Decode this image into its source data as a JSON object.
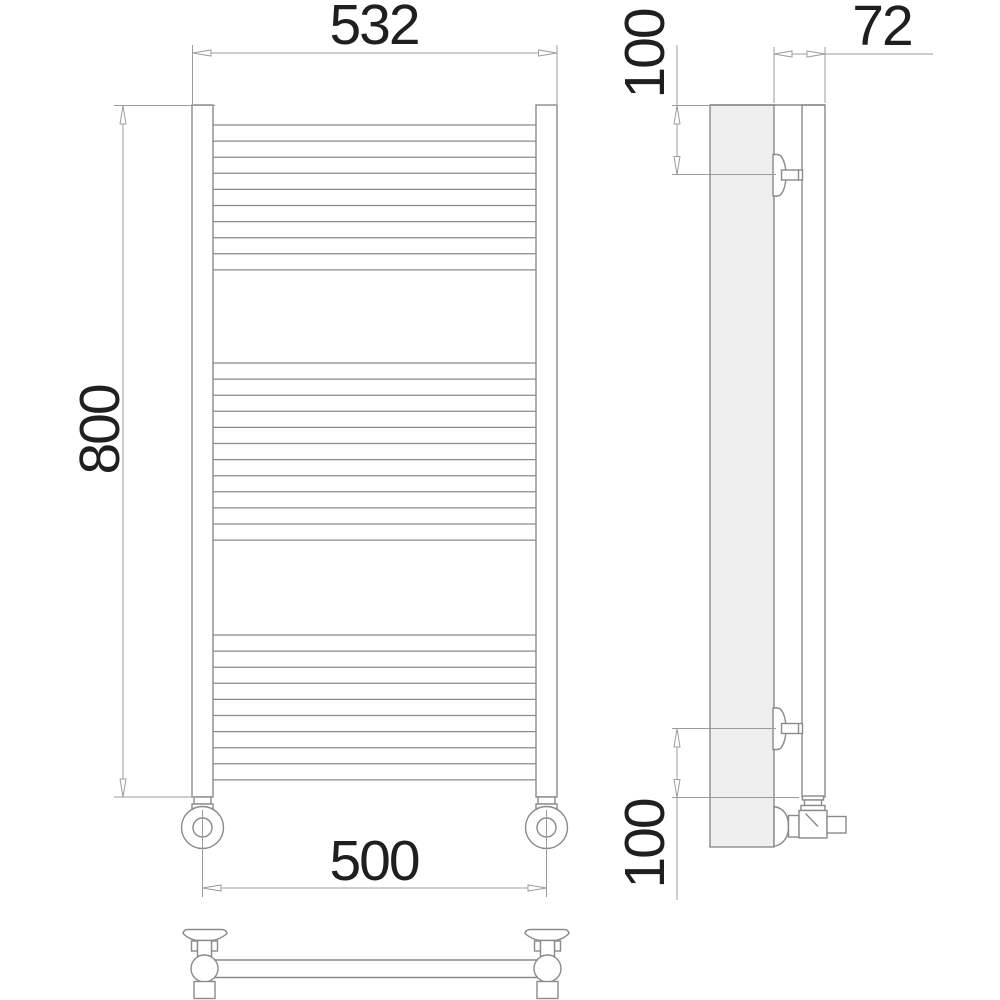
{
  "drawing": {
    "kind": "technical-drawing",
    "subject": "ladder-towel-rail",
    "dimensions": {
      "top_width": "532",
      "height": "800",
      "bottom_width": "500",
      "side_depth": "72",
      "bracket_top_offset": "100",
      "bracket_bottom_offset": "100"
    },
    "front_view": {
      "rung_x1": 213,
      "rung_x2": 536,
      "rung_groups": [
        {
          "count": 10,
          "y_start": 125,
          "spacing": 16.1
        },
        {
          "count": 12,
          "y_start": 363,
          "spacing": 16.1
        },
        {
          "count": 10,
          "y_start": 635,
          "spacing": 16.1
        }
      ]
    },
    "colors": {
      "line": "#8a8a8a",
      "dim": "#9c9c9c",
      "text": "#1f1f1f",
      "panel": "#efefef",
      "background": "#ffffff"
    }
  }
}
